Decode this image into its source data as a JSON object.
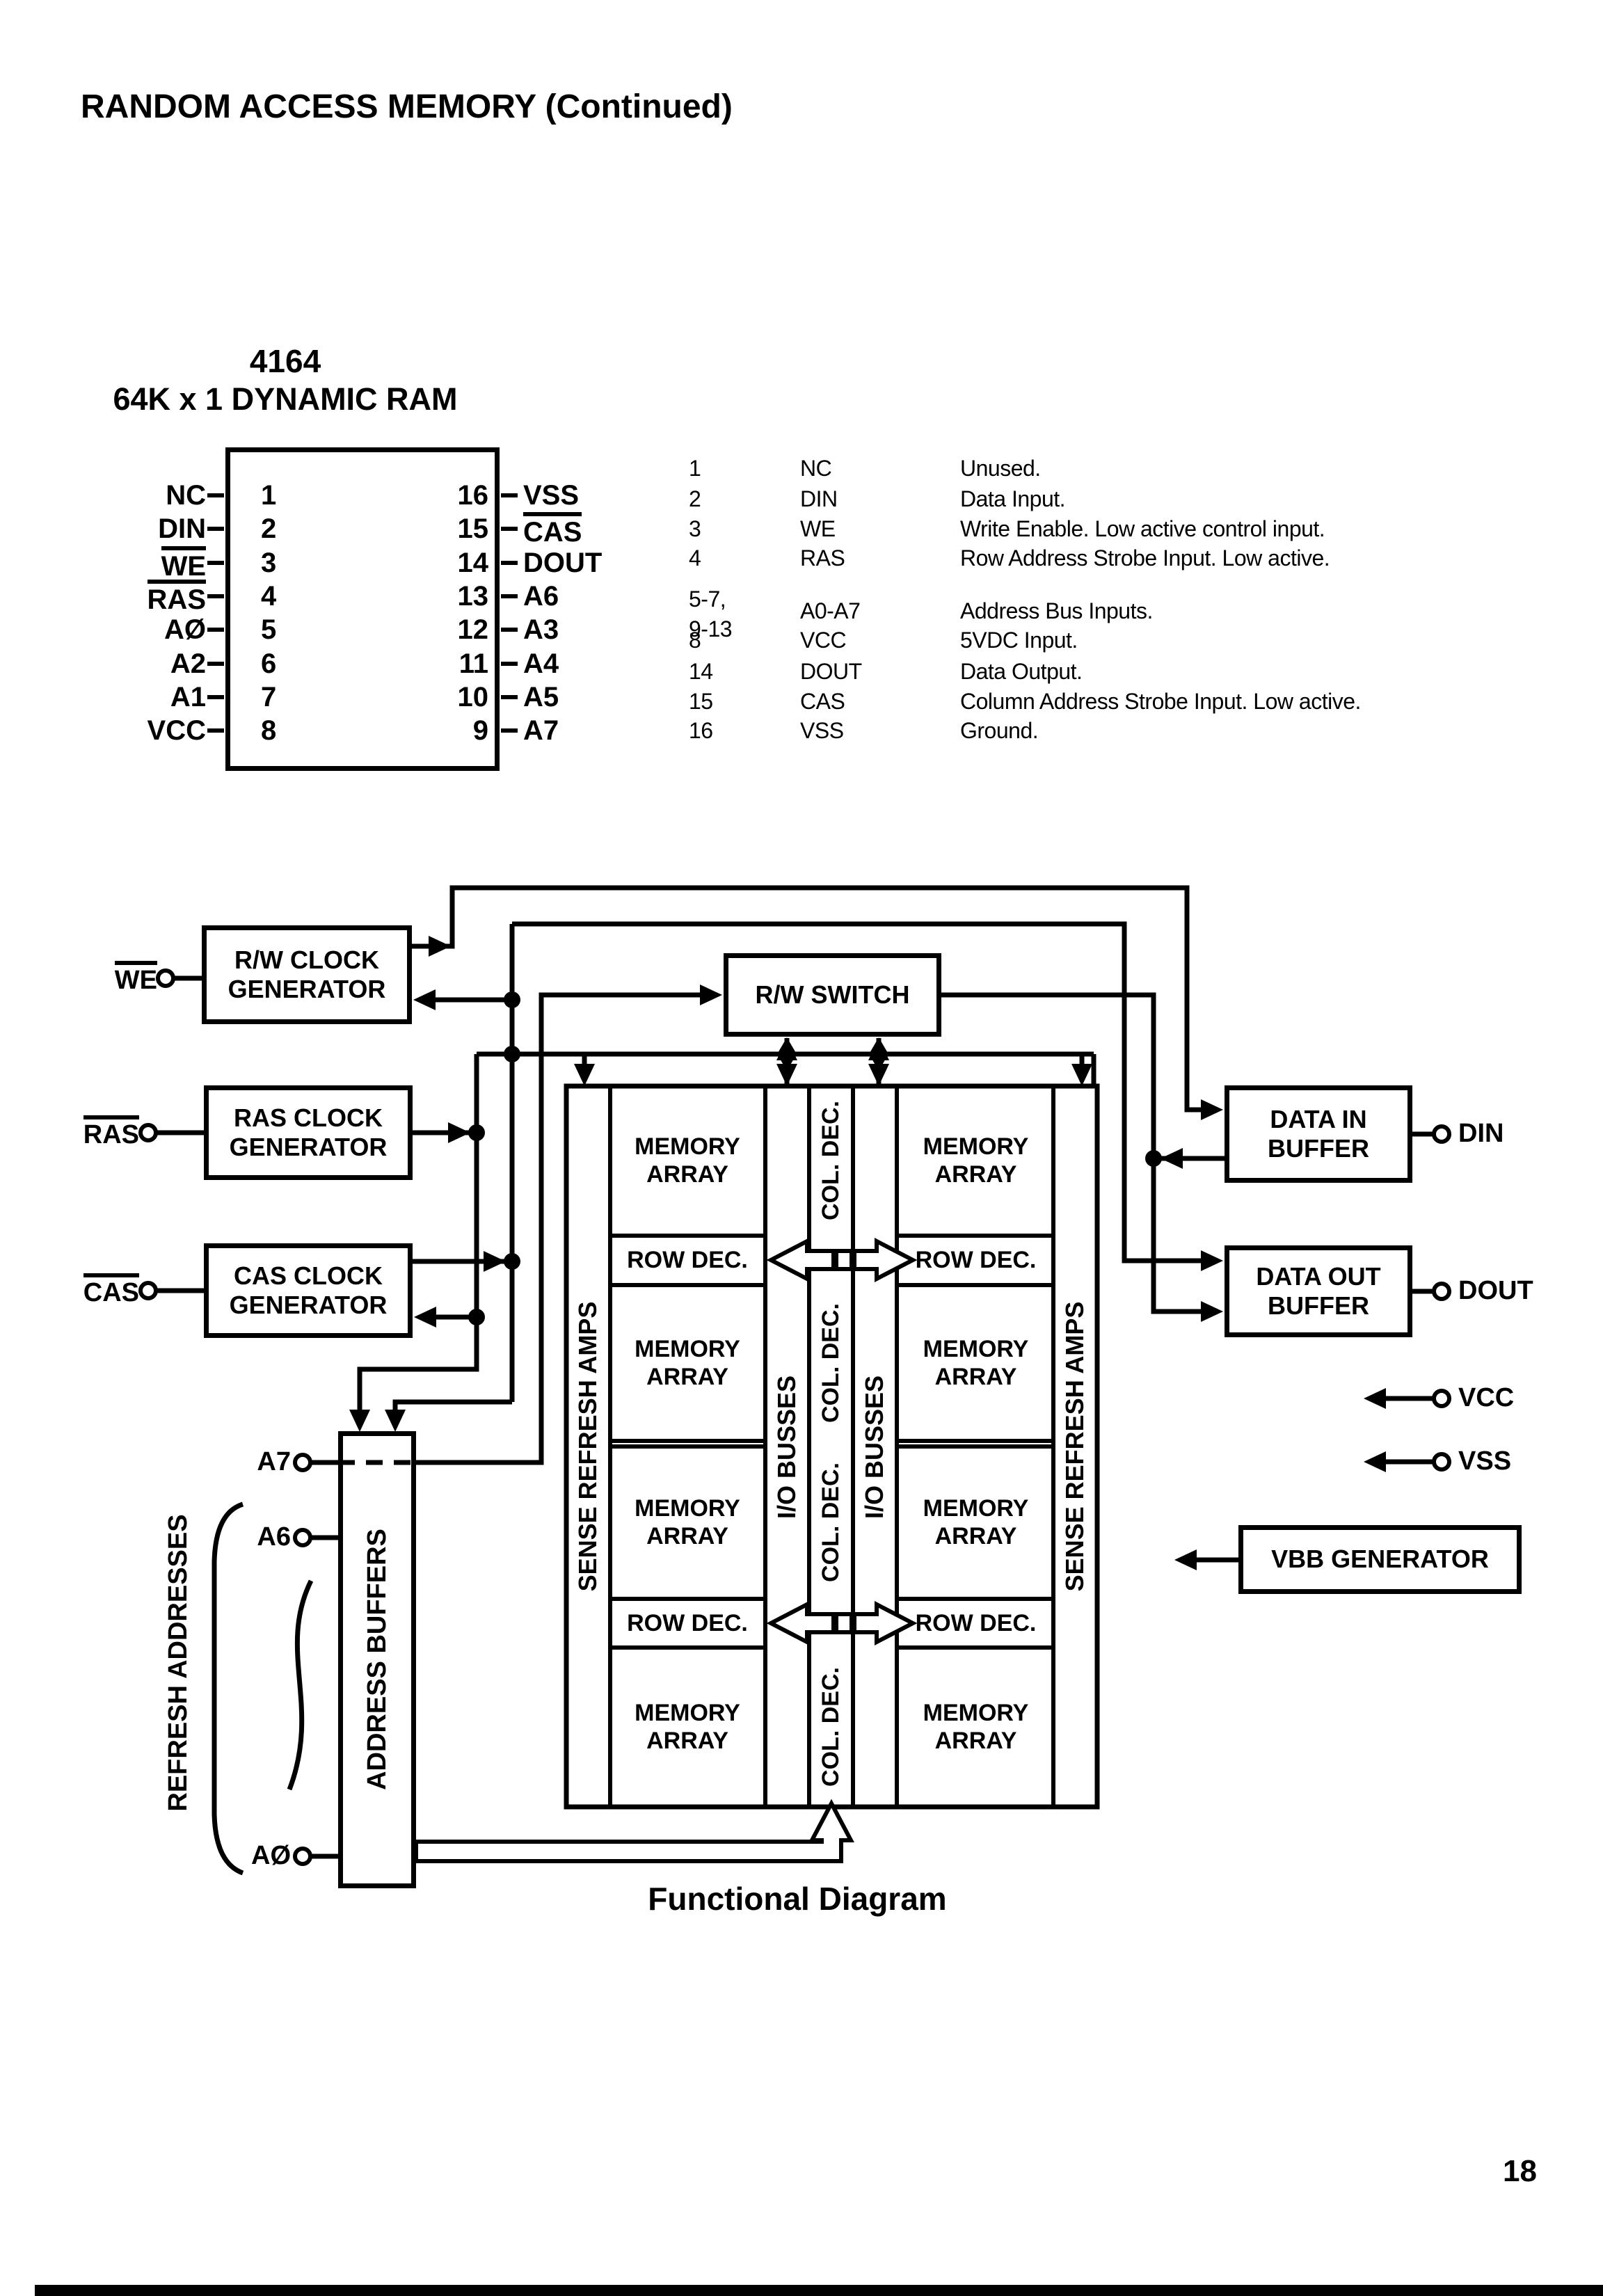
{
  "page": {
    "header": "RANDOM ACCESS MEMORY (Continued)",
    "page_number": "18"
  },
  "chip": {
    "title": "4164",
    "subtitle": "64K x 1 DYNAMIC RAM",
    "left_pins": [
      {
        "label": "NC",
        "number": "1"
      },
      {
        "label": "DIN",
        "number": "2"
      },
      {
        "label": "WE",
        "number": "3",
        "overline": true
      },
      {
        "label": "RAS",
        "number": "4",
        "overline": true
      },
      {
        "label": "AØ",
        "number": "5"
      },
      {
        "label": "A2",
        "number": "6"
      },
      {
        "label": "A1",
        "number": "7"
      },
      {
        "label": "VCC",
        "number": "8"
      }
    ],
    "right_pins": [
      {
        "number": "16",
        "label": "VSS"
      },
      {
        "number": "15",
        "label": "CAS",
        "overline": true
      },
      {
        "number": "14",
        "label": "DOUT"
      },
      {
        "number": "13",
        "label": "A6"
      },
      {
        "number": "12",
        "label": "A3"
      },
      {
        "number": "11",
        "label": "A4"
      },
      {
        "number": "10",
        "label": "A5"
      },
      {
        "number": "9",
        "label": "A7"
      }
    ]
  },
  "pin_table": {
    "rows": [
      {
        "pins": "1",
        "name": "NC",
        "desc": "Unused."
      },
      {
        "pins": "2",
        "name": "DIN",
        "desc": "Data Input."
      },
      {
        "pins": "3",
        "name": "WE",
        "desc": "Write Enable. Low active control input."
      },
      {
        "pins": "4",
        "name": "RAS",
        "desc": "Row Address Strobe Input. Low active."
      },
      {
        "pins": "5-7,\n9-13",
        "name": "A0-A7",
        "desc": "Address Bus Inputs."
      },
      {
        "pins": "8",
        "name": "VCC",
        "desc": "5VDC Input."
      },
      {
        "pins": "14",
        "name": "DOUT",
        "desc": "Data Output."
      },
      {
        "pins": "15",
        "name": "CAS",
        "desc": "Column Address Strobe Input. Low active."
      },
      {
        "pins": "16",
        "name": "VSS",
        "desc": "Ground."
      }
    ]
  },
  "diagram": {
    "caption": "Functional Diagram",
    "boxes": {
      "rw_clock_gen": "R/W CLOCK\nGENERATOR",
      "ras_clock_gen": "RAS CLOCK\nGENERATOR",
      "cas_clock_gen": "CAS CLOCK\nGENERATOR",
      "rw_switch": "R/W SWITCH",
      "data_in_buffer": "DATA IN\nBUFFER",
      "data_out_buffer": "DATA OUT\nBUFFER",
      "vbb_generator": "VBB GENERATOR",
      "address_buffers": "ADDRESS BUFFERS"
    },
    "memory": {
      "array": "MEMORY\nARRAY",
      "row_dec": "ROW DEC.",
      "col_dec": "COL. DEC.",
      "io_busses": "I/O BUSSES",
      "sense_amps": "SENSE REFRESH AMPS"
    },
    "terminals": {
      "we": "WE",
      "ras": "RAS",
      "cas": "CAS",
      "a7": "A7",
      "a6": "A6",
      "a0": "AØ",
      "din": "DIN",
      "dout": "DOUT",
      "vcc": "VCC",
      "vss": "VSS"
    },
    "refresh_label": "REFRESH ADDRESSES"
  }
}
